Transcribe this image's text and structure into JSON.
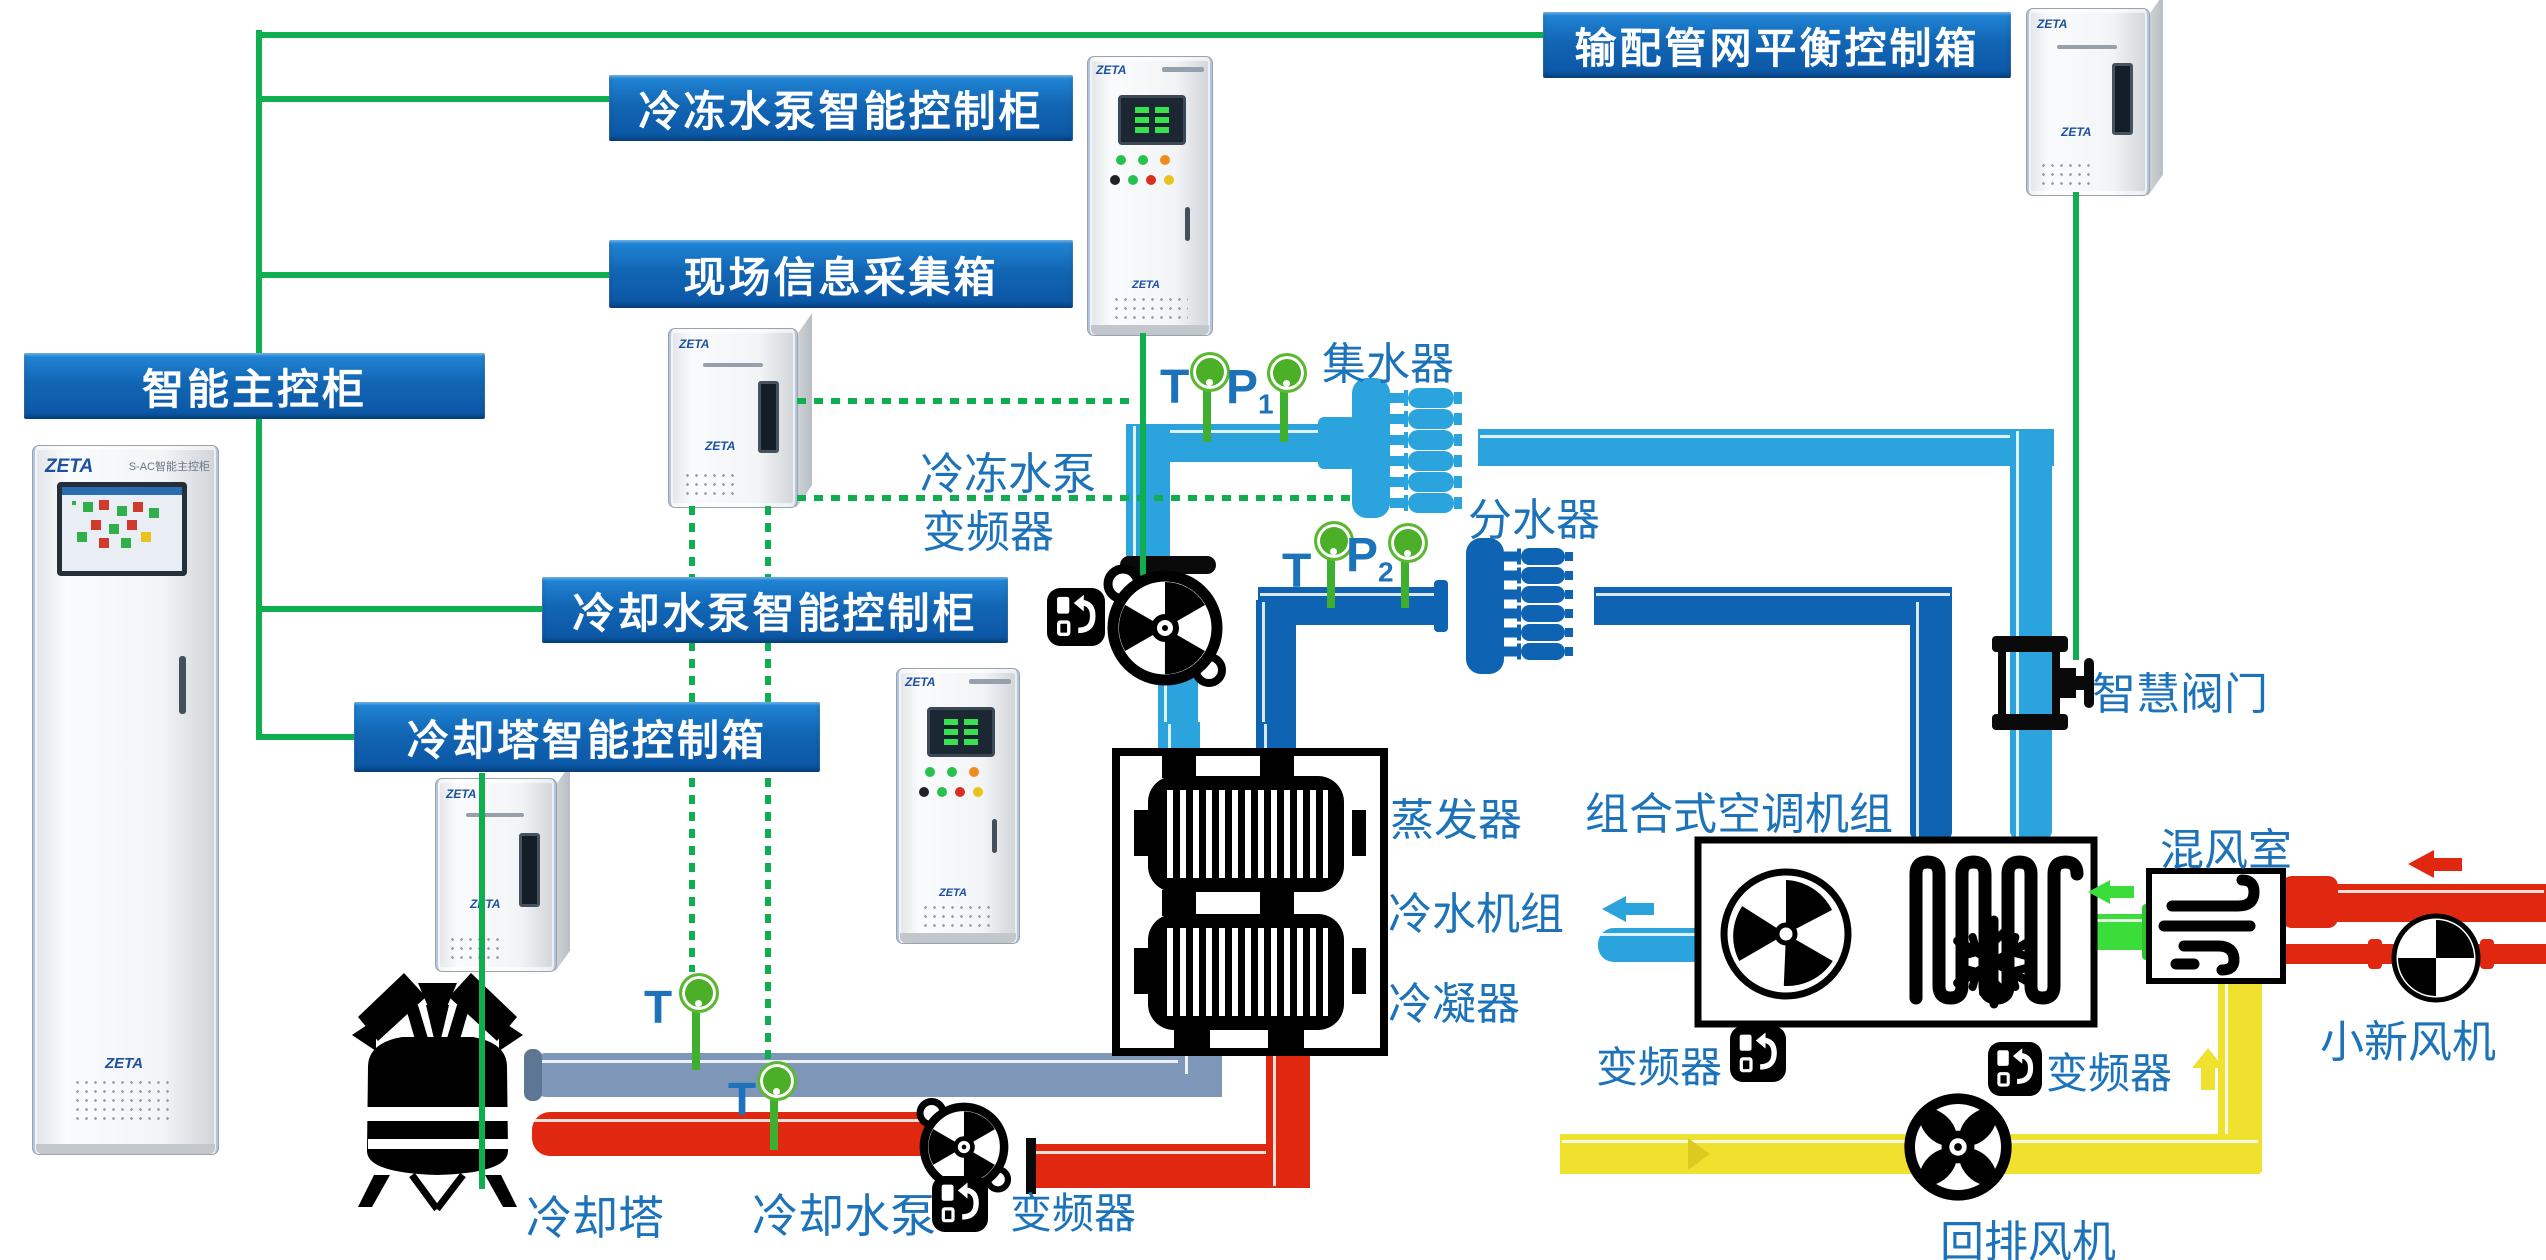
{
  "brand": "ZETA",
  "control_boxes": {
    "distribution": "输配管网平衡控制箱",
    "chw_pump": "冷冻水泵智能控制柜",
    "field_info": "现场信息采集箱",
    "master": "智能主控柜",
    "cw_pump": "冷却水泵智能控制柜",
    "tower": "冷却塔智能控制箱"
  },
  "labels": {
    "collector": "集水器",
    "distributor": "分水器",
    "chw_pump_vfd_line1": "冷冻水泵",
    "chw_pump_vfd_line2": "变频器",
    "evaporator": "蒸发器",
    "chiller": "冷水机组",
    "condenser": "冷凝器",
    "ahu": "组合式空调机组",
    "mixing_room": "混风室",
    "smart_valve": "智慧阀门",
    "vfd": "变频器",
    "return_fan": "回排风机",
    "fresh_fan": "小新风机",
    "cooling_tower": "冷却塔",
    "cooling_pump": "冷却水泵"
  },
  "sensors": {
    "t": "T",
    "p": "P",
    "p1_sub": "1",
    "p2_sub": "2"
  },
  "cabinet_text": {
    "main_model": "S-AC智能主控柜"
  },
  "colors": {
    "network_green": "#0fae4e",
    "chilled_return_lightblue": "#2ba4de",
    "chilled_supply_darkblue": "#0e63b2",
    "cooling_return_gray": "#7e97b8",
    "cooling_supply_red": "#e02810",
    "return_air_yellow": "#f0e12e",
    "supply_air_green": "#3bdd3b",
    "label_box_blue": "#1266b4",
    "text_blue": "#1c73ba"
  }
}
